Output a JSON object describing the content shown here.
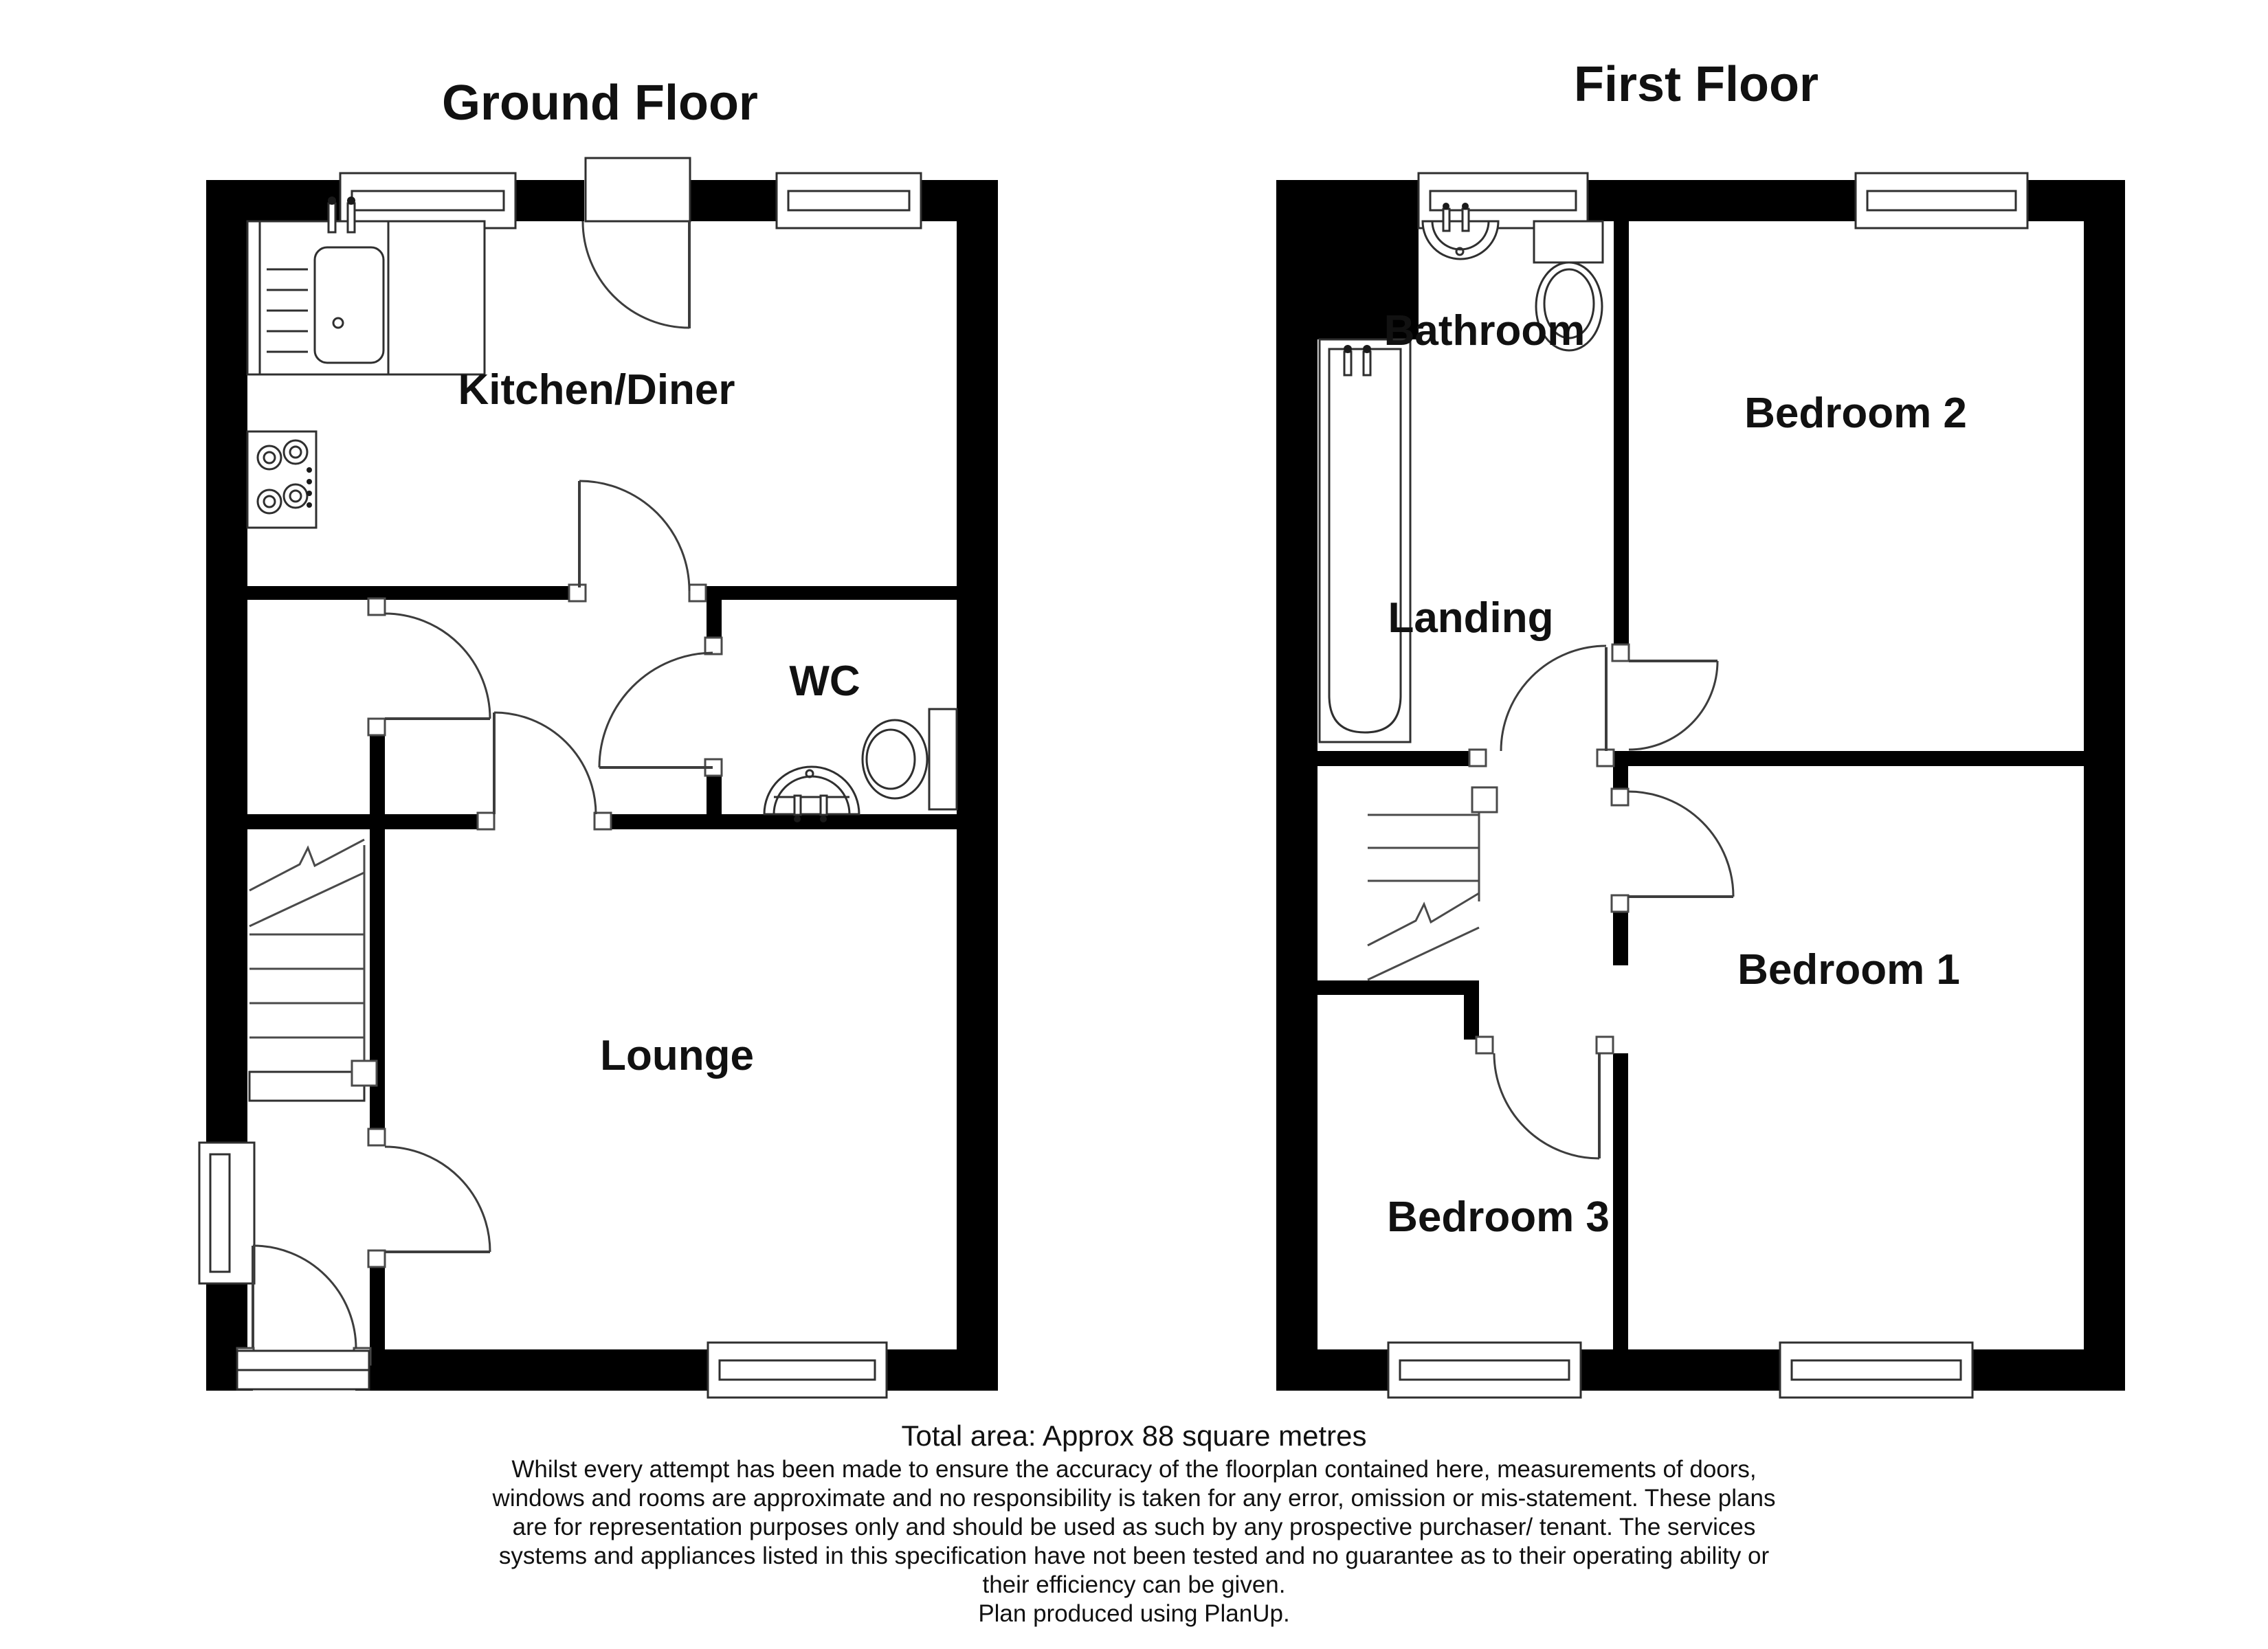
{
  "document": {
    "background": "#ffffff"
  },
  "floors": [
    {
      "title": "Ground Floor",
      "rooms": [
        {
          "id": "kitchen-diner",
          "label": "Kitchen/Diner"
        },
        {
          "id": "wc",
          "label": "WC"
        },
        {
          "id": "lounge",
          "label": "Lounge"
        }
      ],
      "fixtures": [
        "kitchen-sink-drainer",
        "kitchen-taps",
        "hob-4-ring",
        "wc-toilet",
        "wc-basin",
        "staircase-up"
      ]
    },
    {
      "title": "First Floor",
      "rooms": [
        {
          "id": "bathroom",
          "label": "Bathroom"
        },
        {
          "id": "bedroom-2",
          "label": "Bedroom 2"
        },
        {
          "id": "landing",
          "label": "Landing"
        },
        {
          "id": "bedroom-1",
          "label": "Bedroom 1"
        },
        {
          "id": "bedroom-3",
          "label": "Bedroom 3"
        }
      ],
      "fixtures": [
        "bathtub",
        "bathroom-basin",
        "bathroom-toilet",
        "staircase-down"
      ]
    }
  ],
  "footer": {
    "total_area": "Total area: Approx 88 square metres",
    "disclaimer_lines": [
      "Whilst every attempt has been made to ensure the accuracy of the floorplan contained here, measurements of doors,",
      "windows and rooms are approximate and no responsibility is taken for any error, omission or mis-statement. These plans",
      "are for representation purposes only and should be used as such by any prospective purchaser/ tenant. The services",
      "systems and appliances listed in this specification have not been tested and no guarantee as to their operating ability or",
      "their efficiency can be given.",
      "Plan produced using PlanUp."
    ]
  },
  "colors": {
    "wall": "#000000",
    "background": "#ffffff",
    "line": "#3d3d3d",
    "text": "#111111"
  }
}
